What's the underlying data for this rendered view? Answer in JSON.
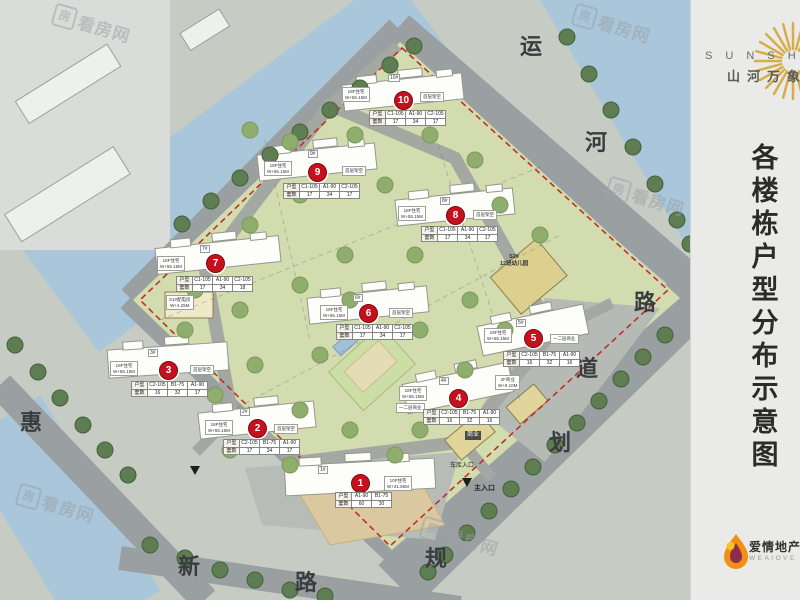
{
  "panel": {
    "brand_en": "S U N S H I",
    "brand_cn": "山河万象",
    "title_chars": [
      "各",
      "楼",
      "栋",
      "户",
      "型",
      "分",
      "布",
      "示",
      "意",
      "图"
    ],
    "footer_cn": "爱情地产",
    "footer_en": "WEAIOVE"
  },
  "watermark": {
    "icon": "房",
    "text": "看房网"
  },
  "road_labels": [
    {
      "ch": "运"
    },
    {
      "ch": "河"
    },
    {
      "ch": "路"
    },
    {
      "ch": "道"
    },
    {
      "ch": "划"
    },
    {
      "ch": "规"
    },
    {
      "ch": "惠"
    },
    {
      "ch": "新"
    },
    {
      "ch": "路"
    }
  ],
  "table_headers": {
    "type": "户型",
    "count": "套数"
  },
  "buildings": [
    {
      "no": "1",
      "tag": "1#",
      "side": [
        "10F住宅",
        "W+31.55M"
      ],
      "cols": [
        "A1-90",
        "B1-75"
      ],
      "counts": [
        "60",
        "30"
      ]
    },
    {
      "no": "2",
      "tag": "2#",
      "left": [
        "18F住宅",
        "W+55.15M"
      ],
      "right": "首层架空",
      "cols": [
        "C2-105",
        "B1-75",
        "A1-90"
      ],
      "counts": [
        "17",
        "34",
        "17"
      ]
    },
    {
      "no": "3",
      "tag": "3#",
      "left": [
        "18F住宅",
        "W+55.15M"
      ],
      "right": "首层架空",
      "cols": [
        "C2-105",
        "B1-75",
        "A1-90"
      ],
      "counts": [
        "16",
        "32",
        "17"
      ]
    },
    {
      "no": "4",
      "tag": "4#",
      "left": [
        "18F住宅",
        "W+55.15M"
      ],
      "left2": "一二层商业",
      "cols": [
        "C2-105",
        "B1-75",
        "A1-90"
      ],
      "counts": [
        "16",
        "32",
        "16"
      ]
    },
    {
      "no": "5",
      "tag": "5#",
      "left": [
        "18F住宅",
        "W+55.15M"
      ],
      "right": "一二层商业",
      "cols": [
        "C2-105",
        "B1-75",
        "A1-90"
      ],
      "counts": [
        "16",
        "32",
        "16"
      ]
    },
    {
      "no": "6",
      "tag": "6#",
      "left": [
        "18F住宅",
        "W+55.15M"
      ],
      "right": "首层架空",
      "cols": [
        "C1-105",
        "A1-90",
        "C2-105"
      ],
      "counts": [
        "17",
        "34",
        "17"
      ]
    },
    {
      "no": "7",
      "tag": "7#",
      "left": [
        "18F住宅",
        "W+55.15M"
      ],
      "right": "",
      "cols": [
        "C1-105",
        "A1-90",
        "C2-105"
      ],
      "counts": [
        "17",
        "34",
        "18"
      ]
    },
    {
      "no": "8",
      "tag": "8#",
      "left": [
        "18F住宅",
        "W+55.15M"
      ],
      "right": "首层架空",
      "cols": [
        "C1-105",
        "A1-90",
        "C2-105"
      ],
      "counts": [
        "17",
        "34",
        "17"
      ]
    },
    {
      "no": "9",
      "tag": "9#",
      "left": [
        "18F住宅",
        "W+55.15M"
      ],
      "right": "首层架空",
      "cols": [
        "C1-105",
        "A1-90",
        "C2-105"
      ],
      "counts": [
        "17",
        "34",
        "17"
      ]
    },
    {
      "no": "10",
      "tag": "10#",
      "left": [
        "18F住宅",
        "W+55.15M"
      ],
      "right": "首层架空",
      "cols": [
        "C1-105",
        "A1-90",
        "C2-105"
      ],
      "counts": [
        "17",
        "34",
        "17"
      ]
    }
  ],
  "annotations": {
    "kindergarten_1": "S2#",
    "kindergarten_2": "12班幼儿园",
    "power_room_1": "S1#配电房",
    "power_room_2": "W+4.25M",
    "commercial": "商业",
    "commercial_2f_1": "2F商业",
    "commercial_2f_2": "W+8.10M",
    "main_entrance": "主入口",
    "garage_entrance": "车库入口"
  }
}
